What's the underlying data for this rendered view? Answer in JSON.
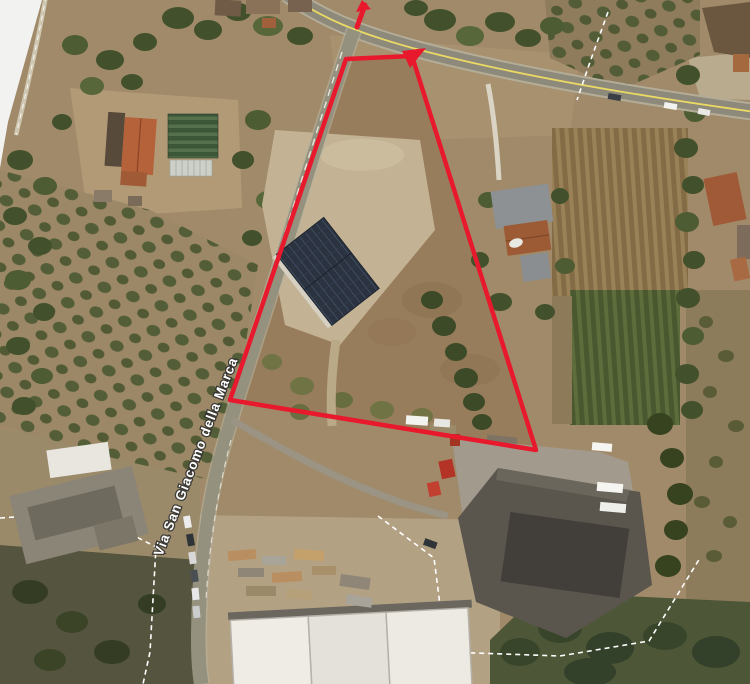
{
  "map": {
    "road_label": "Via San Giacomo della Marca",
    "annotation": {
      "color": "#e8192c",
      "parcel_outline_points": "346,59 412,56 536,450 230,400",
      "apex_arrowhead_points": "426,48 402,51 410,68",
      "road_tick_points": "365,5 357,27",
      "road_tick_head_points": "371,9 362,0 356,12"
    },
    "colors": {
      "road_center_line": "#ead964",
      "boundary_dash": "#ffffff"
    }
  }
}
